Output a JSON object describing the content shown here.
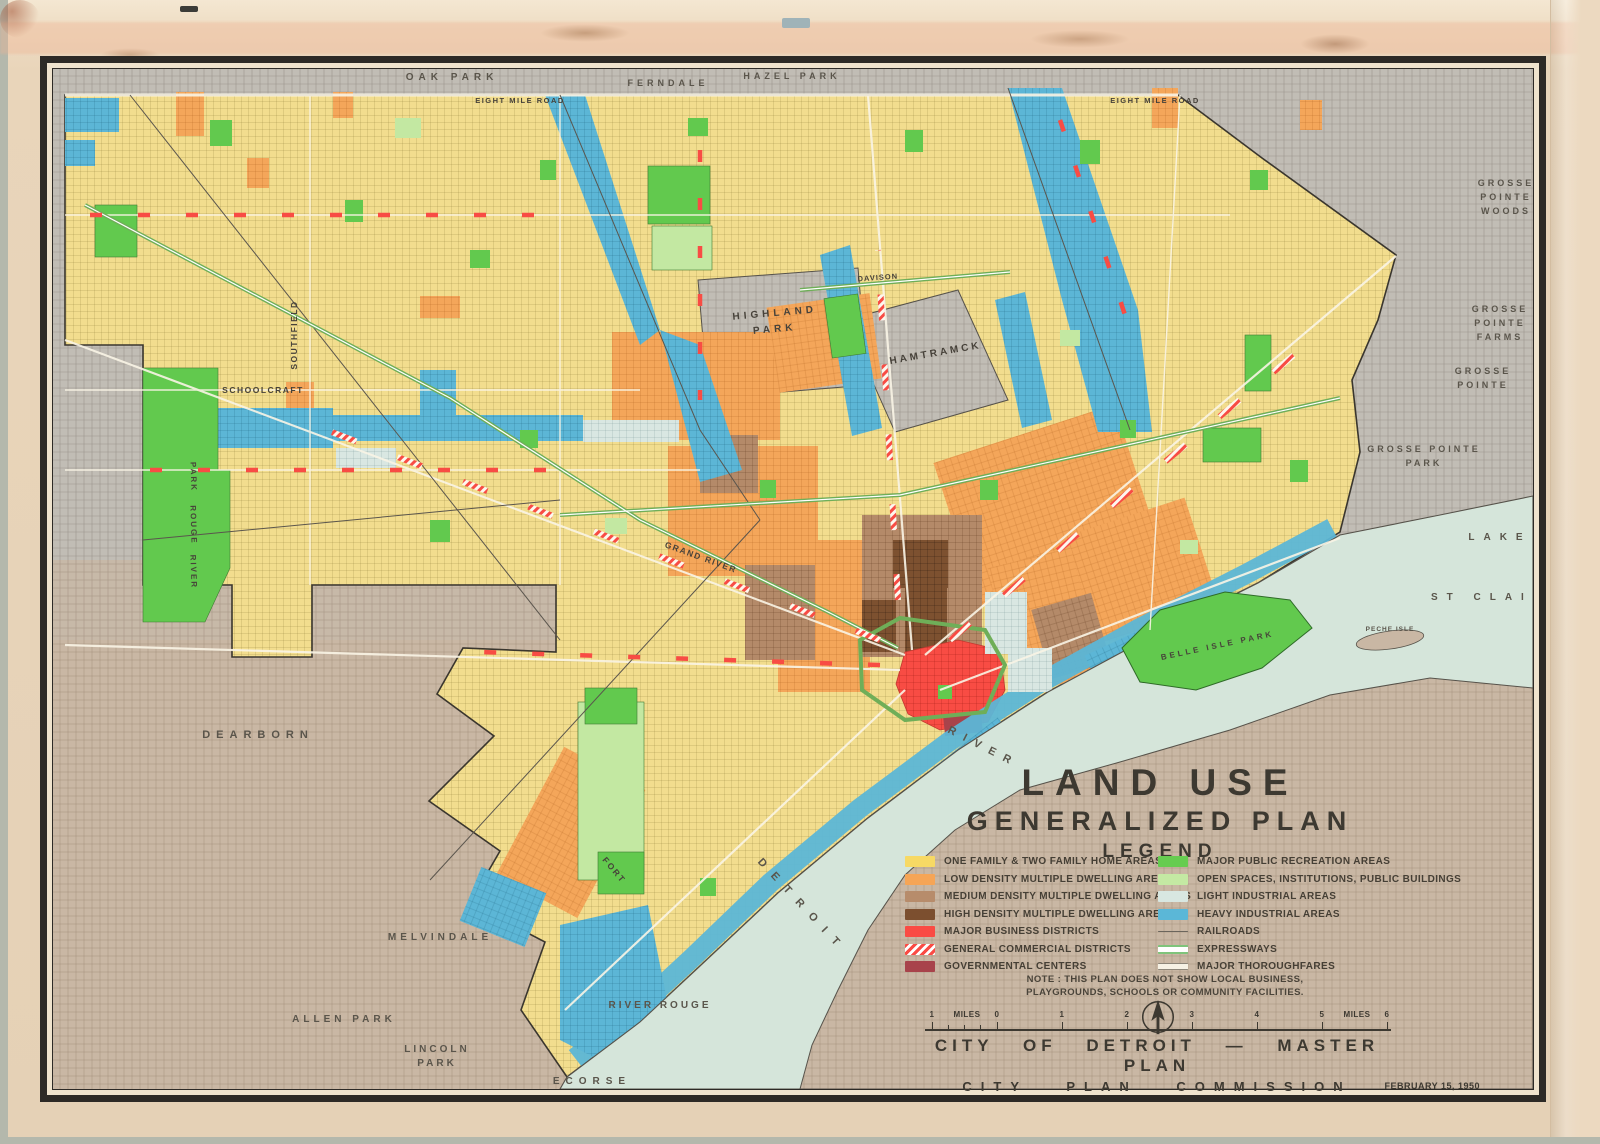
{
  "title_block": {
    "line1": "LAND USE",
    "line2": "GENERALIZED PLAN",
    "legend_heading": "LEGEND",
    "note_line1": "NOTE : THIS PLAN DOES NOT SHOW LOCAL BUSINESS,",
    "note_line2": "PLAYGROUNDS, SCHOOLS OR COMMUNITY FACILITIES."
  },
  "legend": {
    "left": [
      {
        "label": "ONE FAMILY & TWO FAMILY HOME AREAS",
        "color": "#F7D964",
        "type": "solid"
      },
      {
        "label": "LOW DENSITY MULTIPLE DWELLING AREAS",
        "color": "#F6A556",
        "type": "solid"
      },
      {
        "label": "MEDIUM DENSITY MULTIPLE DWELLING AREAS",
        "color": "#B78C6B",
        "type": "solid"
      },
      {
        "label": "HIGH DENSITY MULTIPLE DWELLING AREAS",
        "color": "#7C4F2F",
        "type": "solid"
      },
      {
        "label": "MAJOR BUSINESS DISTRICTS",
        "color": "#FA4B44",
        "type": "solid"
      },
      {
        "label": "GENERAL COMMERCIAL DISTRICTS",
        "color": "#FA4B44",
        "type": "hatch"
      },
      {
        "label": "GOVERNMENTAL CENTERS",
        "color": "#A8434B",
        "type": "solid"
      }
    ],
    "right": [
      {
        "label": "MAJOR PUBLIC RECREATION AREAS",
        "color": "#66CC50",
        "type": "solid"
      },
      {
        "label": "OPEN SPACES, INSTITUTIONS, PUBLIC BUILDINGS",
        "color": "#C4E9A3",
        "type": "solid"
      },
      {
        "label": "LIGHT INDUSTRIAL AREAS",
        "color": "#D8E7E1",
        "type": "solid"
      },
      {
        "label": "HEAVY INDUSTRIAL AREAS",
        "color": "#5BB7D7",
        "type": "solid"
      },
      {
        "label": "RAILROADS",
        "color": "#6B655C",
        "type": "railroad"
      },
      {
        "label": "EXPRESSWAYS",
        "color": "#7FC47B",
        "type": "expressway"
      },
      {
        "label": "MAJOR THOROUGHFARES",
        "color": "#C9C2B2",
        "type": "thoroughfare"
      }
    ]
  },
  "scale_bar": {
    "labels": [
      "1",
      "MILES",
      "0",
      "1",
      "2",
      "3",
      "4",
      "5",
      "MILES",
      "6"
    ]
  },
  "attribution": {
    "line1": "CITY OF DETROIT — MASTER PLAN",
    "line2": "CITY PLAN COMMISSION"
  },
  "date_stamp": "FEBRUARY 15, 1950",
  "map": {
    "colors": {
      "city_residential": "#F2DD8E",
      "suburb_grey": "#C1BDB5",
      "downriver_tan": "#C9B7A4",
      "water": "#D5E5DA",
      "canada_shore": "#C7B5A3",
      "park_green": "#62C94E",
      "open_space_green": "#C3E8A2",
      "heavy_industrial_blue": "#5CB6D6",
      "light_industrial": "#D9E7E2",
      "low_density_orange": "#F4A65A",
      "medium_density_brown": "#B48A69",
      "high_density_brown": "#7D5130",
      "business_red": "#F84C44",
      "governmental_maroon": "#A8434B",
      "expressway_green": "#6FAE58"
    },
    "labels": {
      "oak_park": "OAK PARK",
      "ferndale": "FERNDALE",
      "hazel_park": "HAZEL PARK",
      "eight_mile_w": "EIGHT MILE ROAD",
      "eight_mile_e": "EIGHT MILE ROAD",
      "gpw1": "GROSSE",
      "gpw2": "POINTE",
      "gpw3": "WOODS",
      "gpf1": "GROSSE",
      "gpf2": "POINTE",
      "gpf3": "FARMS",
      "gp1": "GROSSE",
      "gp2": "POINTE",
      "gpp1": "GROSSE POINTE",
      "gpp2": "PARK",
      "lake": "LAKE",
      "st_clair": "ST CLAIR",
      "highland1": "HIGHLAND",
      "highland2": "PARK",
      "hamtramck": "HAMTRAMCK",
      "davison": "DAVISON",
      "schoolcraft": "SCHOOLCRAFT",
      "southfield": "SOUTHFIELD",
      "grand_river": "GRAND RIVER",
      "fort": "FORT",
      "detroit_river_1": "DETROIT",
      "detroit_river_2": "RIVER",
      "belle_isle": "BELLE ISLE PARK",
      "peche_isle": "PECHE ISLE",
      "dearborn": "DEARBORN",
      "melvindale": "MELVINDALE",
      "allen_park": "ALLEN PARK",
      "lincoln1": "LINCOLN",
      "lincoln2": "PARK",
      "river_rouge": "RIVER ROUGE",
      "ecorse": "ECORSE",
      "rouge_park1": "PARK",
      "rouge_park2": "ROUGE",
      "rouge_park3": "RIVER"
    }
  }
}
